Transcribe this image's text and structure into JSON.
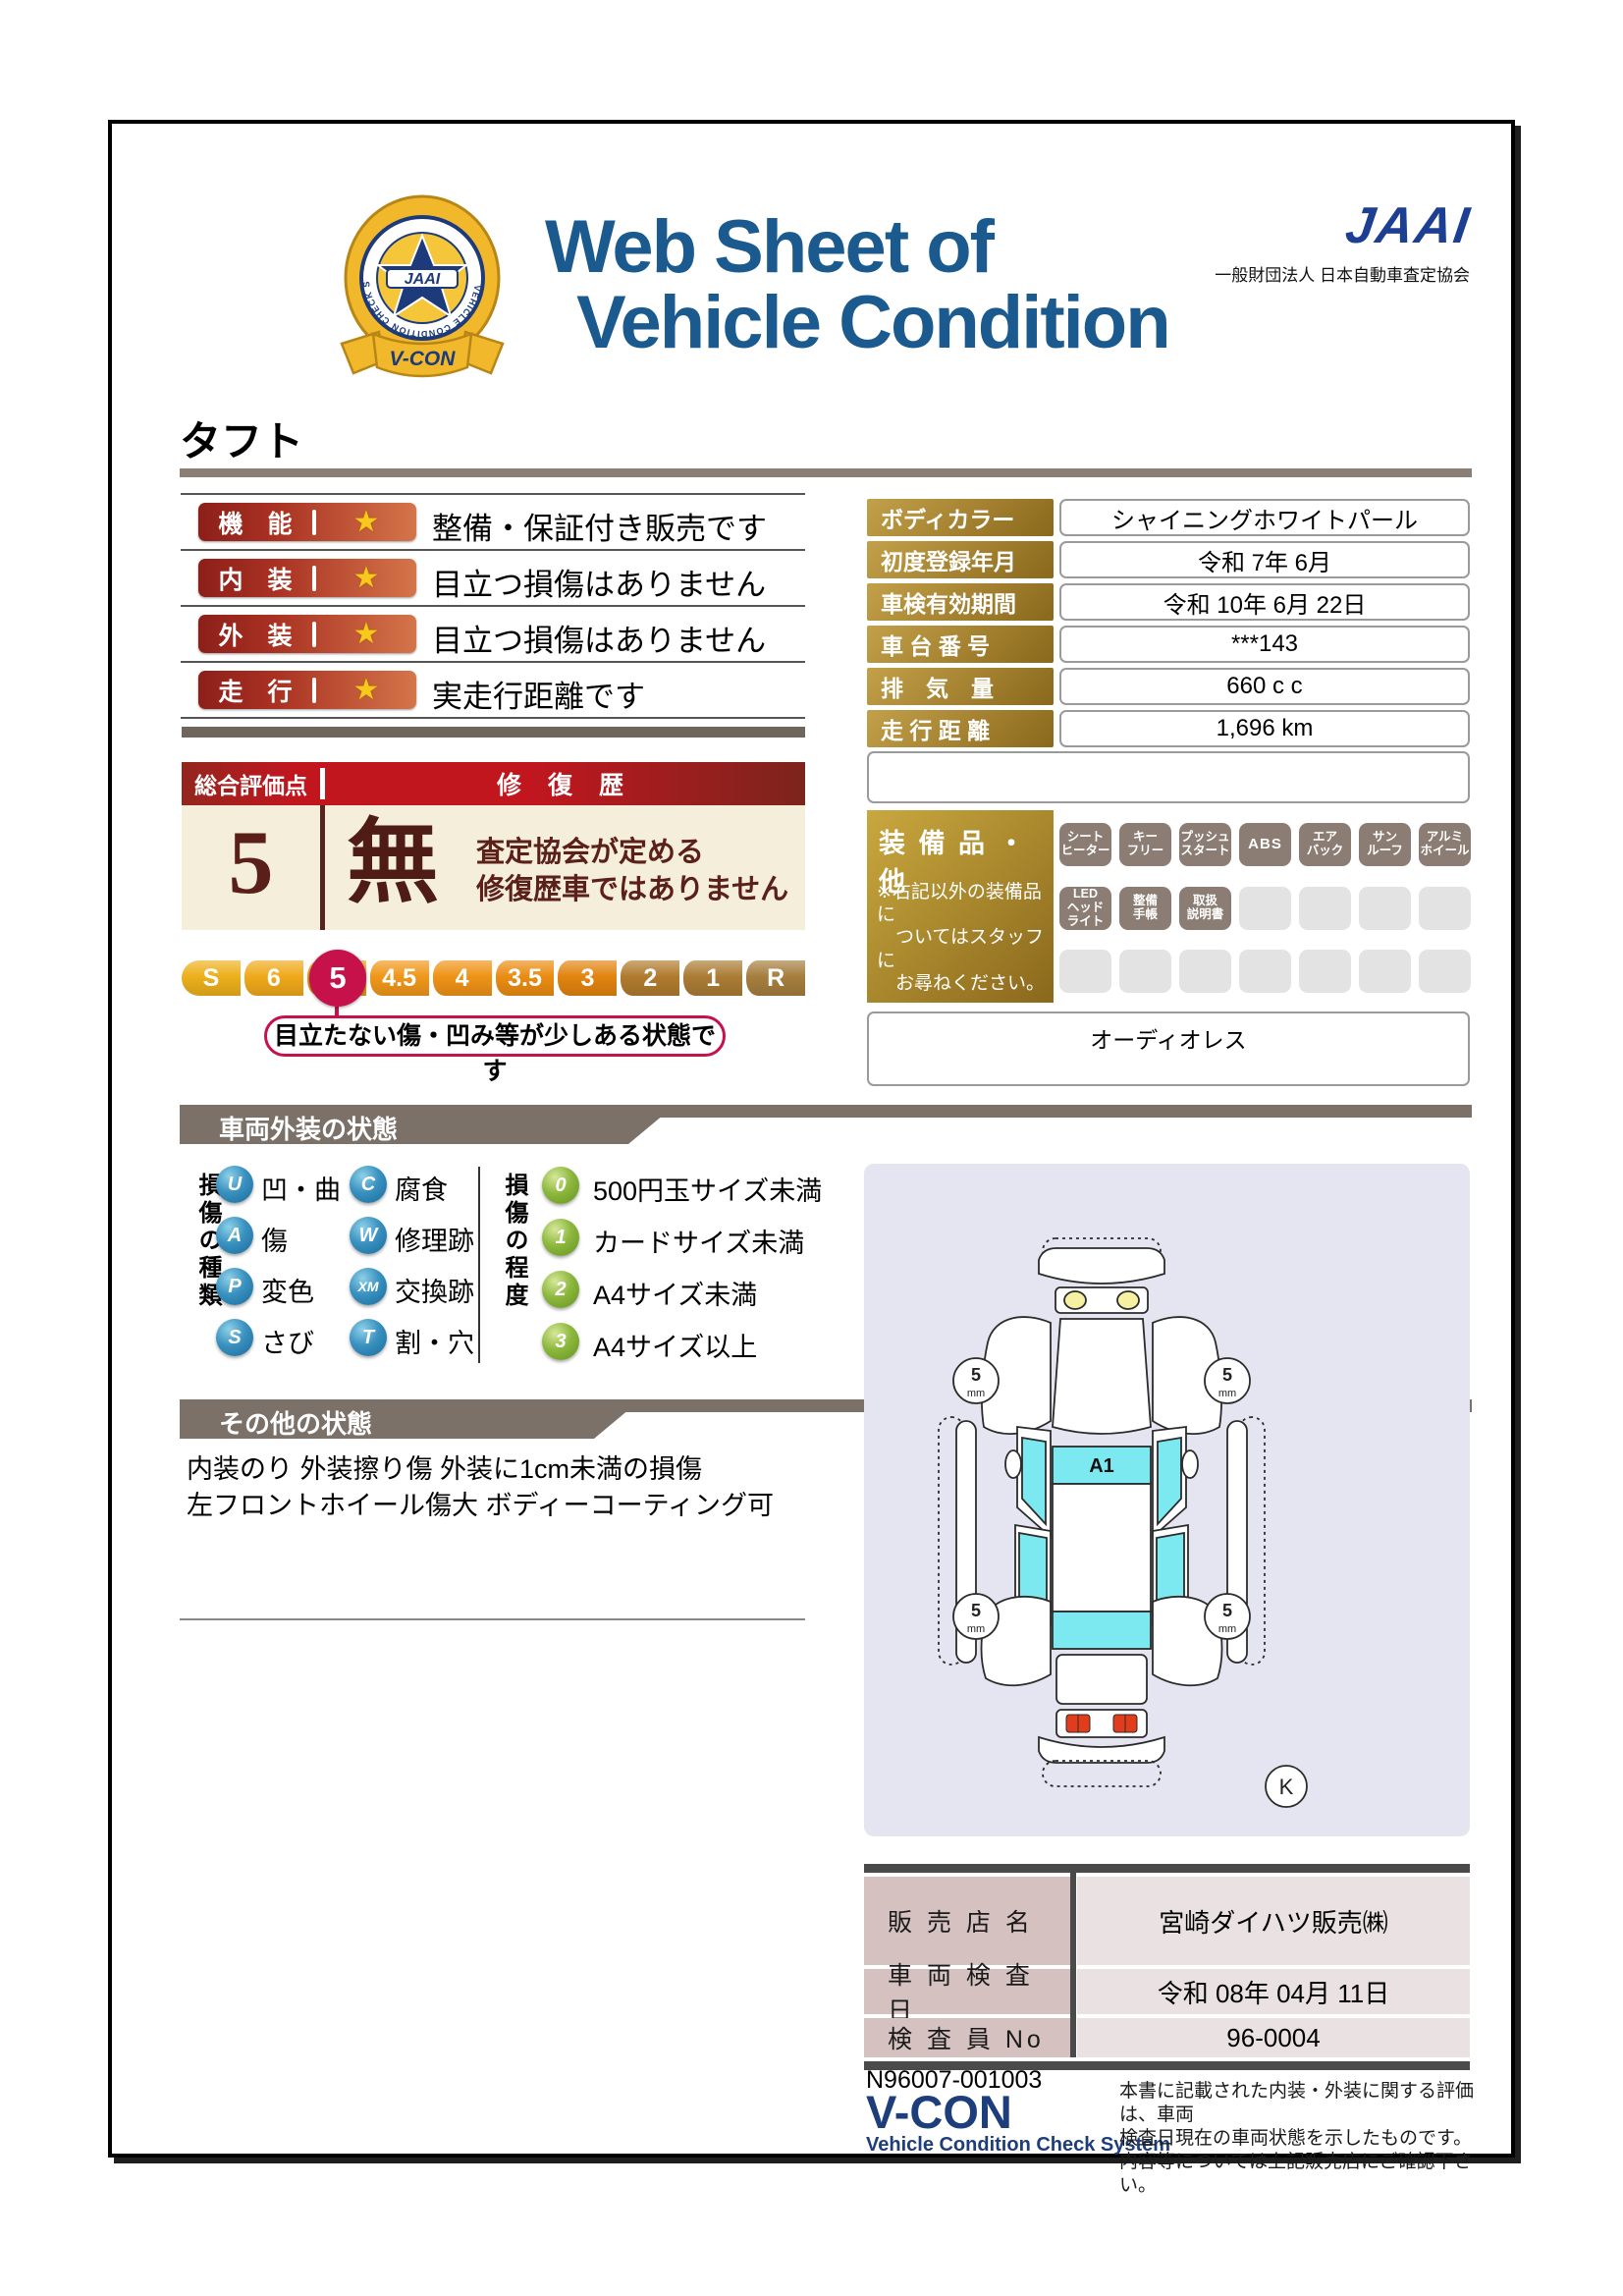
{
  "header": {
    "title_line1": "Web Sheet of",
    "title_line2": "Vehicle Condition",
    "jaai_logo": "JAAI",
    "jaai_subtitle": "一般財団法人 日本自動車査定協会",
    "emblem": {
      "center": "JAAI",
      "ribbon": "V-CON",
      "ring": "VEHICLE CONDITION CHECK SYSTEM"
    }
  },
  "vehicle_name": "タフト",
  "ratings_star": "★",
  "ratings": [
    {
      "label": "機　能",
      "description": "整備・保証付き販売です"
    },
    {
      "label": "内　装",
      "description": "目立つ損傷はありません"
    },
    {
      "label": "外　装",
      "description": "目立つ損傷はありません"
    },
    {
      "label": "走　行",
      "description": "実走行距離です"
    }
  ],
  "info_table": [
    {
      "label": "ボディカラー",
      "value": "シャイニングホワイトパール"
    },
    {
      "label": "初度登録年月",
      "value": "令和 7年 6月"
    },
    {
      "label": "車検有効期間",
      "value": "令和 10年 6月 22日"
    },
    {
      "label": "車 台 番 号",
      "value": "***143"
    },
    {
      "label": "排　気　量",
      "value": "660 c c"
    },
    {
      "label": "走 行 距 離",
      "value": "1,696 km"
    }
  ],
  "overall": {
    "score_label": "総合評価点",
    "score": "5",
    "repair_label": "修 復 歴",
    "repair_value": "無",
    "repair_desc": [
      "査定協会が定める",
      "修復歴車ではありません"
    ]
  },
  "scale": {
    "segments": [
      "S",
      "6",
      "5",
      "4.5",
      "4",
      "3.5",
      "3",
      "2",
      "1",
      "R"
    ],
    "selected": "5",
    "callout": "目立たない傷・凹み等が少しある状態です"
  },
  "equipment": {
    "title": "装 備 品 ・ 他",
    "note": [
      "※右記以外の装備品に",
      "　ついてはスタッフに",
      "　お尋ねください。"
    ],
    "badges_row1": [
      [
        "シート",
        "ヒーター"
      ],
      [
        "キー",
        "フリー"
      ],
      [
        "プッシュ",
        "スタート"
      ],
      [
        "ABS"
      ],
      [
        "エア",
        "バック"
      ],
      [
        "サン",
        "ルーフ"
      ],
      [
        "アルミ",
        "ホイール"
      ]
    ],
    "badges_row2": [
      [
        "LED",
        "ヘッド",
        "ライト"
      ],
      [
        "整備",
        "手帳"
      ],
      [
        "取扱",
        "説明書"
      ]
    ],
    "audio": "オーディオレス"
  },
  "exterior": {
    "banner": "車両外装の状態",
    "type_title": "損傷の種類",
    "types": [
      {
        "code": "U",
        "label": "凹・曲"
      },
      {
        "code": "C",
        "label": "腐食"
      },
      {
        "code": "A",
        "label": "傷"
      },
      {
        "code": "W",
        "label": "修理跡"
      },
      {
        "code": "P",
        "label": "変色"
      },
      {
        "code": "XM",
        "label": "交換跡"
      },
      {
        "code": "S",
        "label": "さび"
      },
      {
        "code": "T",
        "label": "割・穴"
      }
    ],
    "degree_title": "損傷の程度",
    "degrees": [
      {
        "code": "0",
        "label": "500円玉サイズ未満"
      },
      {
        "code": "1",
        "label": "カードサイズ未満"
      },
      {
        "code": "2",
        "label": "A4サイズ未満"
      },
      {
        "code": "3",
        "label": "A4サイズ以上"
      }
    ]
  },
  "other_condition": {
    "banner": "その他の状態",
    "lines": [
      "内装のり 外装擦り傷 外装に1cm未満の損傷",
      "左フロントホイール傷大 ボディーコーティング可"
    ]
  },
  "diagram": {
    "roof_label": "A1",
    "tread_value": "5",
    "tread_unit": "mm",
    "corner_mark": "K"
  },
  "dealer": {
    "rows": [
      {
        "label": "販 売 店 名",
        "value": "宮崎ダイハツ販売㈱"
      },
      {
        "label": "車 両 検 査 日",
        "value": "令和 08年 04月 11日"
      },
      {
        "label": "検 査 員 No",
        "value": "96-0004"
      }
    ]
  },
  "footer": {
    "code": "N96007-001003",
    "vcon": "V-CON",
    "vcon_sub": "Vehicle Condition Check System",
    "note": [
      "本書に記載された内装・外装に関する評価は、車両",
      "検査日現在の車両状態を示したものです。",
      "内容等については上記販売店にご確認下さい。"
    ]
  }
}
